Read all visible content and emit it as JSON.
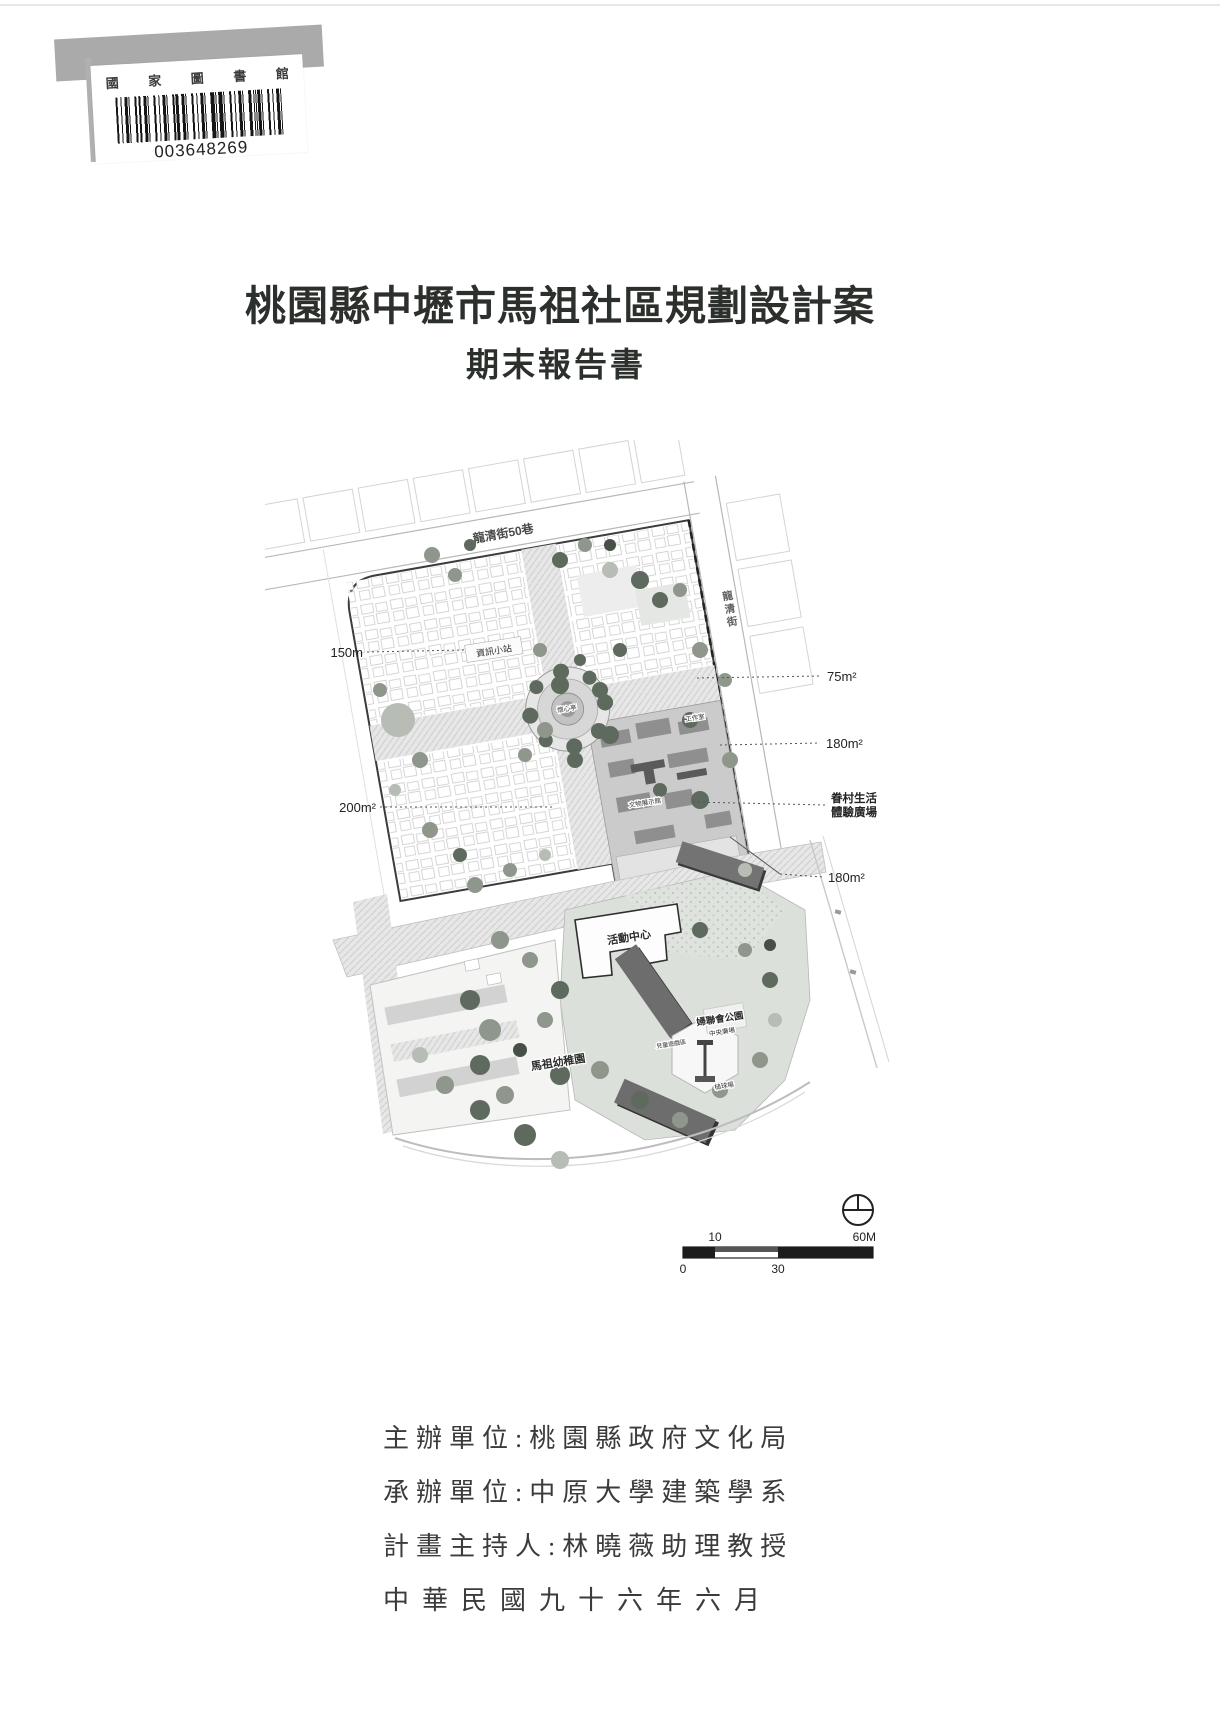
{
  "library_sticker": {
    "institution": "國 家 圖 書 館",
    "barcode_number": "003648269"
  },
  "titles": {
    "main": "桃園縣中壢市馬祖社區規劃設計案",
    "sub": "期末報告書"
  },
  "site_plan": {
    "streets": {
      "top": "龍清街50巷",
      "right_chars": [
        "龍",
        "清",
        "街"
      ]
    },
    "callouts": {
      "left_150m": "150m",
      "left_200m2": "200m²",
      "right_75m2": "75m²",
      "right_180m2_a": "180m²",
      "right_plaza_line1": "眷村生活",
      "right_plaza_line2": "體驗廣場",
      "right_180m2_b": "180m²"
    },
    "labels": {
      "info_station": "資訊小站",
      "pavilion": "懷心亭",
      "workshop": "工作室",
      "exhibit_hall": "文物展示館",
      "activity_center": "活動中心",
      "kindergarten": "馬祖幼稚園",
      "park": "婦聯會公園",
      "central_plaza": "中央廣場",
      "play_area": "兒童遊戲區",
      "gateball": "槌球場"
    },
    "scale_bar": {
      "top_left": "10",
      "top_right": "60M",
      "bottom_left": "0",
      "bottom_mid": "30"
    }
  },
  "credits": {
    "line1": "主辦單位:桃園縣政府文化局",
    "line2": "承辦單位:中原大學建築學系",
    "line3": "計畫主持人:林曉薇助理教授",
    "date": "中華民國九十六年六月"
  }
}
